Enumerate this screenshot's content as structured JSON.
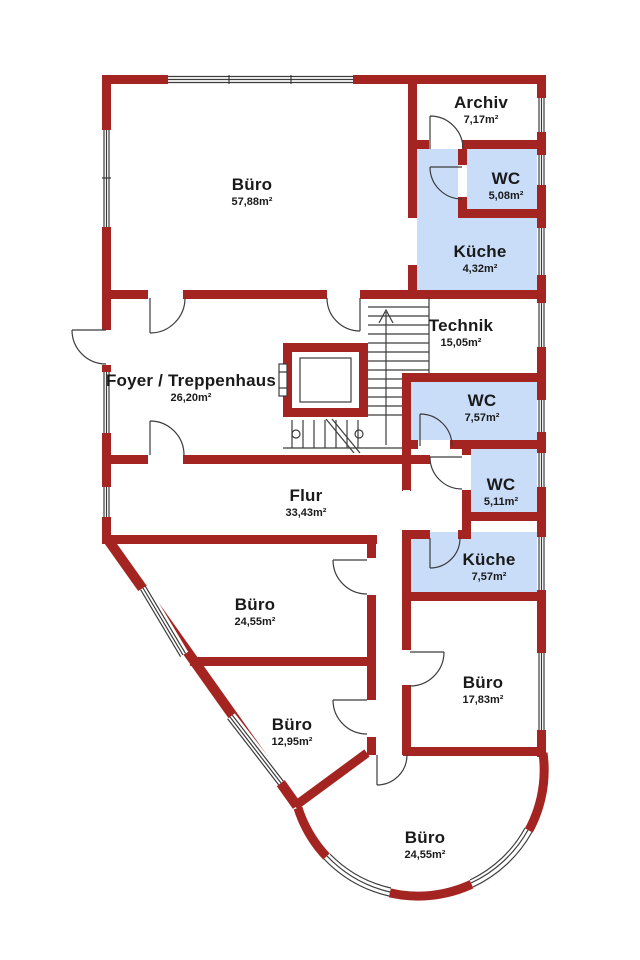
{
  "plan": {
    "title": "Grundriss Obergeschoss",
    "rooms": [
      {
        "name": "Büro",
        "area": "57,88m²"
      },
      {
        "name": "Archiv",
        "area": "7,17m²"
      },
      {
        "name": "WC",
        "area": "5,08m²"
      },
      {
        "name": "Küche",
        "area": "4,32m²"
      },
      {
        "name": "Technik",
        "area": "15,05m²"
      },
      {
        "name": "Foyer / Treppenhaus",
        "area": "26,20m²"
      },
      {
        "name": "WC",
        "area": "7,57m²"
      },
      {
        "name": "WC",
        "area": "5,11m²"
      },
      {
        "name": "Küche",
        "area": "7,57m²"
      },
      {
        "name": "Flur",
        "area": "33,43m²"
      },
      {
        "name": "Büro",
        "area": "24,55m²"
      },
      {
        "name": "Büro",
        "area": "12,95m²"
      },
      {
        "name": "Büro",
        "area": "17,83m²"
      },
      {
        "name": "Büro",
        "area": "24,55m²"
      }
    ],
    "colors": {
      "wall": "#a32421",
      "room_highlight": "#c9dcf8",
      "line": "#3c3c3c",
      "text": "#1a1a1a",
      "background": "#ffffff"
    }
  }
}
